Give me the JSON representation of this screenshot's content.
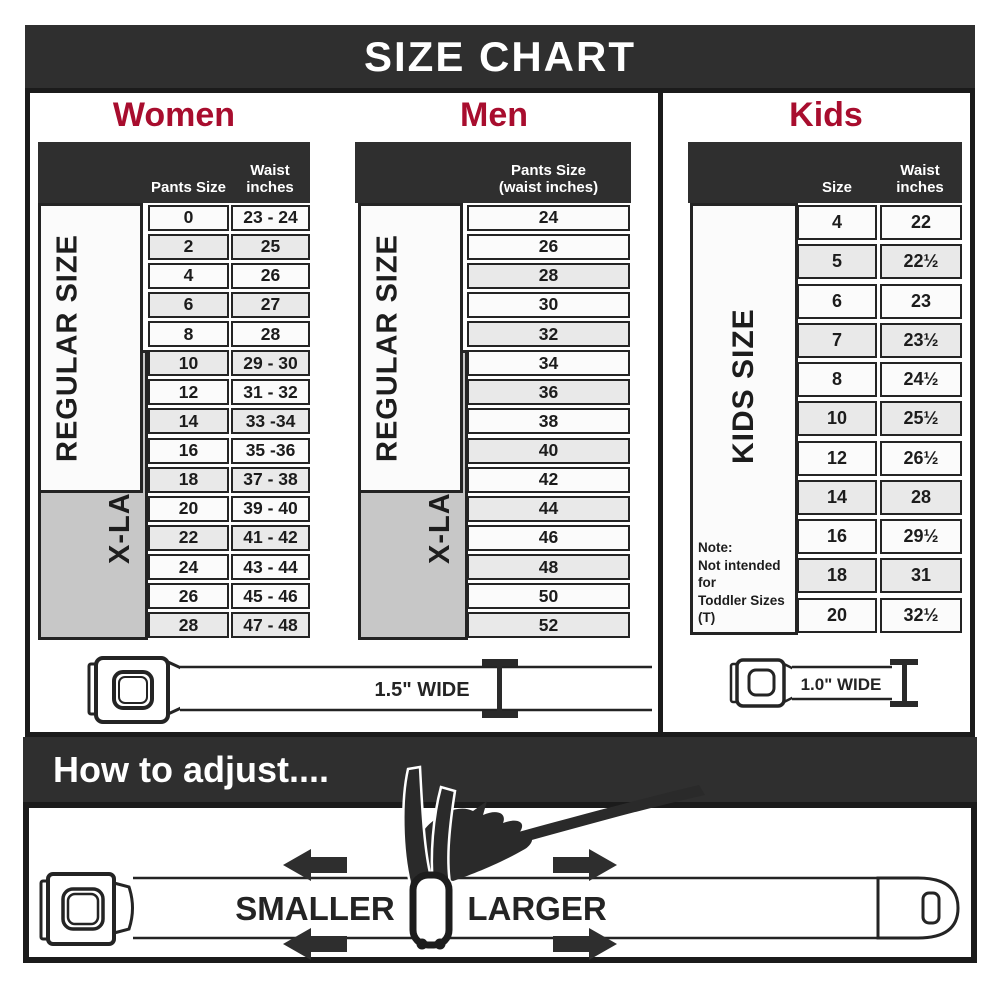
{
  "title": "SIZE CHART",
  "colors": {
    "accent": "#A80D2E",
    "dark": "#2F2F2F",
    "row_light": "#FBFBFB",
    "row_shaded": "#E9E9E9",
    "xl_gray": "#C7C7C7"
  },
  "women": {
    "heading": "Women",
    "col1_header": "Pants Size",
    "col2_header": "Waist inches",
    "regular_label": "REGULAR SIZE",
    "xlarge_label": "X-LARGE",
    "belt_label": "1.5\" WIDE",
    "rows": [
      {
        "size": "0",
        "waist": "23 - 24",
        "shaded": false
      },
      {
        "size": "2",
        "waist": "25",
        "shaded": true
      },
      {
        "size": "4",
        "waist": "26",
        "shaded": false
      },
      {
        "size": "6",
        "waist": "27",
        "shaded": true
      },
      {
        "size": "8",
        "waist": "28",
        "shaded": false
      },
      {
        "size": "10",
        "waist": "29 - 30",
        "shaded": true
      },
      {
        "size": "12",
        "waist": "31 - 32",
        "shaded": false
      },
      {
        "size": "14",
        "waist": "33 -34",
        "shaded": true
      },
      {
        "size": "16",
        "waist": "35 -36",
        "shaded": false
      },
      {
        "size": "18",
        "waist": "37 - 38",
        "shaded": true
      },
      {
        "size": "20",
        "waist": "39 - 40",
        "shaded": false
      },
      {
        "size": "22",
        "waist": "41 - 42",
        "shaded": true
      },
      {
        "size": "24",
        "waist": "43 - 44",
        "shaded": false
      },
      {
        "size": "26",
        "waist": "45 - 46",
        "shaded": false
      },
      {
        "size": "28",
        "waist": "47 - 48",
        "shaded": true
      }
    ]
  },
  "men": {
    "heading": "Men",
    "col_header_line1": "Pants Size",
    "col_header_line2": "(waist inches)",
    "regular_label": "REGULAR SIZE",
    "xlarge_label": "X-LARGE",
    "rows": [
      {
        "size": "24",
        "shaded": false
      },
      {
        "size": "26",
        "shaded": false
      },
      {
        "size": "28",
        "shaded": true
      },
      {
        "size": "30",
        "shaded": false
      },
      {
        "size": "32",
        "shaded": true
      },
      {
        "size": "34",
        "shaded": false
      },
      {
        "size": "36",
        "shaded": true
      },
      {
        "size": "38",
        "shaded": false
      },
      {
        "size": "40",
        "shaded": true
      },
      {
        "size": "42",
        "shaded": false
      },
      {
        "size": "44",
        "shaded": true
      },
      {
        "size": "46",
        "shaded": false
      },
      {
        "size": "48",
        "shaded": true
      },
      {
        "size": "50",
        "shaded": false
      },
      {
        "size": "52",
        "shaded": true
      }
    ]
  },
  "kids": {
    "heading": "Kids",
    "col1_header": "Size",
    "col2_header": "Waist inches",
    "side_label": "KIDS SIZE",
    "belt_label": "1.0\" WIDE",
    "note": [
      "Note:",
      "Not intended for",
      "Toddler Sizes (T)"
    ],
    "rows": [
      {
        "size": "4",
        "waist": "22",
        "shaded": false
      },
      {
        "size": "5",
        "waist": "22½",
        "shaded": true
      },
      {
        "size": "6",
        "waist": "23",
        "shaded": false
      },
      {
        "size": "7",
        "waist": "23½",
        "shaded": true
      },
      {
        "size": "8",
        "waist": "24½",
        "shaded": false
      },
      {
        "size": "10",
        "waist": "25½",
        "shaded": true
      },
      {
        "size": "12",
        "waist": "26½",
        "shaded": false
      },
      {
        "size": "14",
        "waist": "28",
        "shaded": true
      },
      {
        "size": "16",
        "waist": "29½",
        "shaded": false
      },
      {
        "size": "18",
        "waist": "31",
        "shaded": true
      },
      {
        "size": "20",
        "waist": "32½",
        "shaded": false
      }
    ]
  },
  "adjust": {
    "heading": "How to adjust....",
    "smaller_label": "SMALLER",
    "larger_label": "LARGER"
  }
}
